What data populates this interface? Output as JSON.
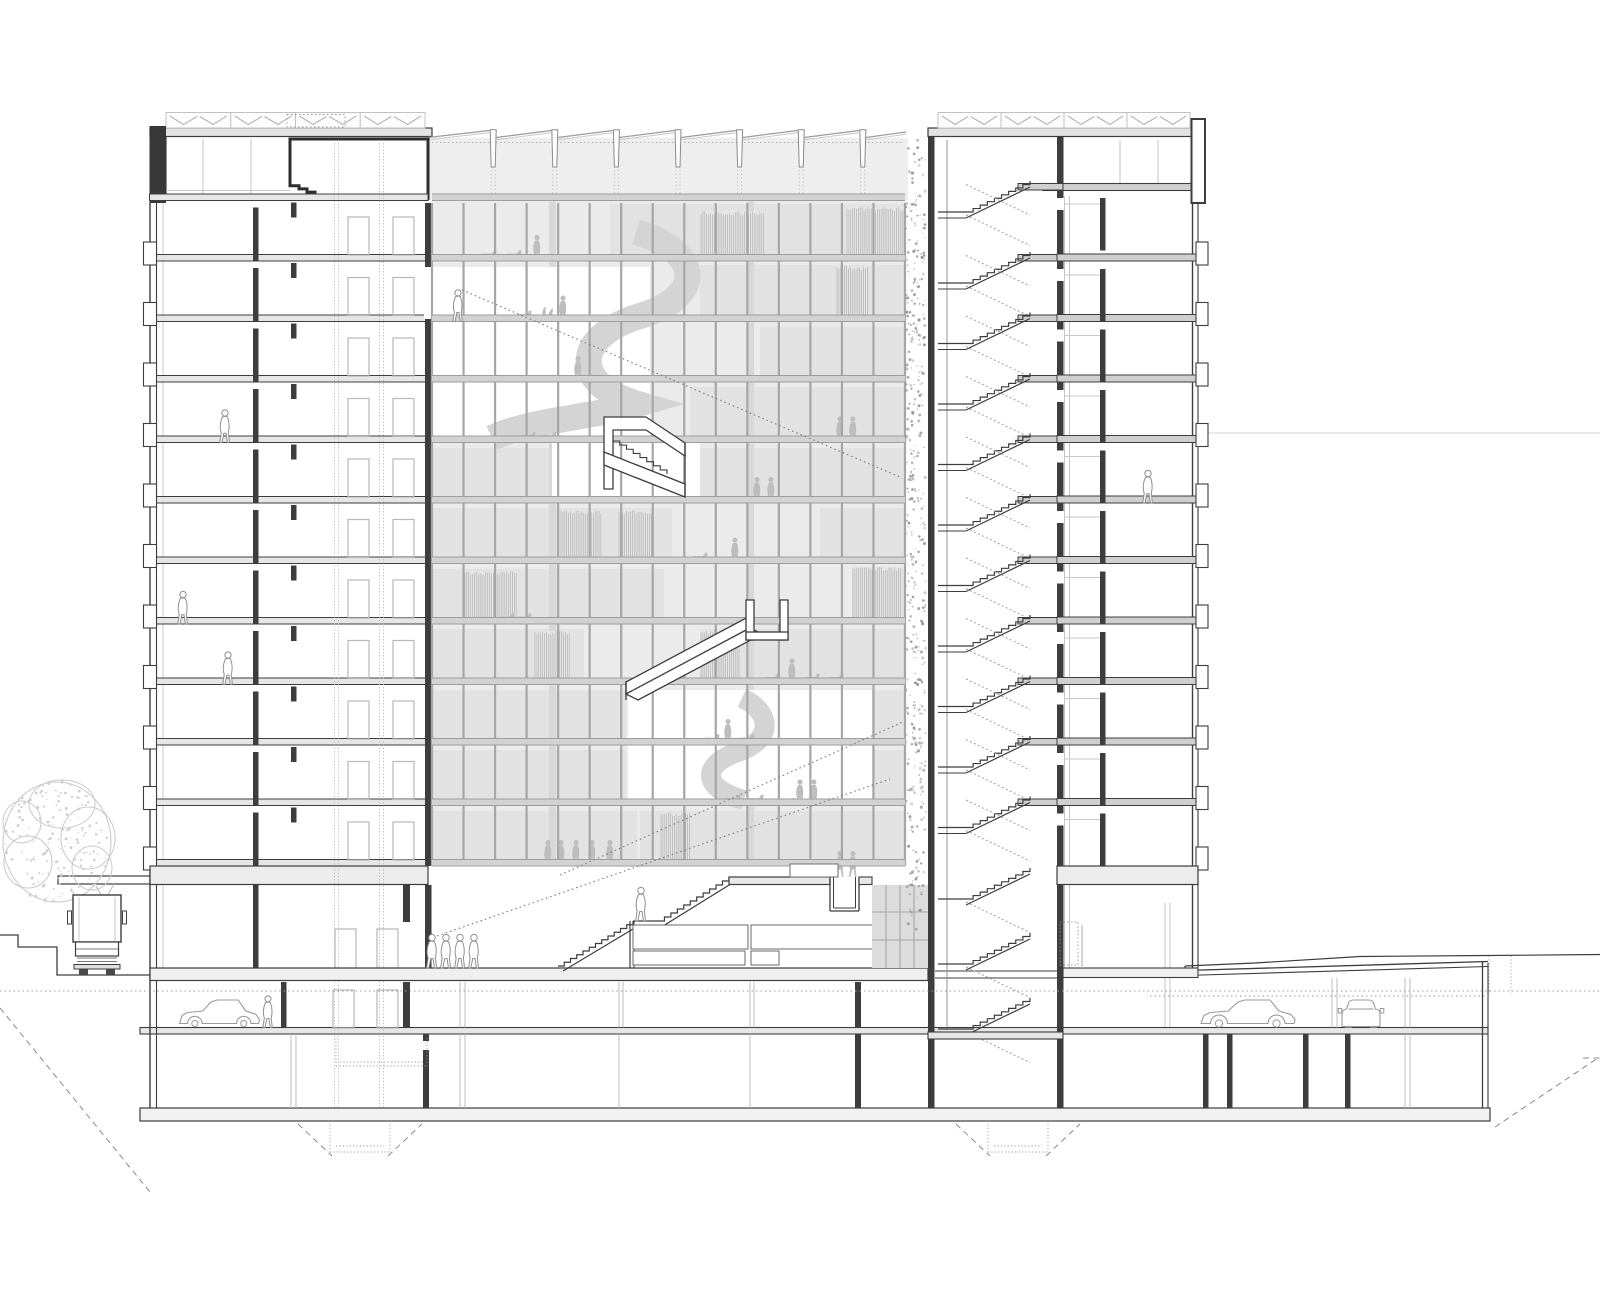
{
  "document": {
    "kind": "architectural cross-section drawing",
    "title": "Building section – atrium tower with underground parking",
    "style": "black and white technical line drawing, no text labels",
    "visible_text": []
  },
  "palette": {
    "paper": "#ffffff",
    "ink": "#3d3d3d",
    "inkMed": "#7a7a7a",
    "inkLight": "#b5b5b5",
    "inkXlight": "#d2d2d2",
    "atriumBg": "#ebebeb",
    "band": "#d2d2d2",
    "tint": "#e2e2e2",
    "strip": "#d8d8d8",
    "sil": "#bdbdbd",
    "silOut": "#8f8f8f",
    "hatch": "#b2b2b2",
    "sawFill": "#eeeeee",
    "glazing": "#dcdcdc",
    "green": "#8c8c8c",
    "spiral": "#d4d4d4",
    "slabFill": "#e6e6e6",
    "wheel": "#4a4a4a",
    "carLine": "#9a9a9a",
    "treeLine": "#c9c9c9"
  },
  "structure": {
    "storeys_above_ground": 13,
    "typical_floor_count": 11,
    "basement_levels": 2,
    "zones": [
      "left-wing",
      "central-atrium",
      "scissor-stair-core",
      "green-wall",
      "right-wing",
      "underground-parking"
    ],
    "roof": {
      "left_louver_panels": 4,
      "right_louver_panels": 4,
      "sawtooth_modules": 7
    },
    "core_flights_above_ground": 11,
    "core_flights_below_ground": 3,
    "atrium_mullion_bays": 15
  },
  "entities": {
    "people_outlined": 11,
    "people_filled": 19,
    "chairs": 16,
    "plants": 1,
    "dogs": 1,
    "cars": 3,
    "trucks": 1,
    "trees": 1,
    "spiral_stairs": 2,
    "straight_atrium_stairs": 1,
    "diagonal_bridges": 1,
    "grand_entry_stairs": 1
  },
  "annotations": {
    "sight_lines": 3,
    "groundwater_datum_line": true,
    "excavation_dashed_lines": true,
    "foundation_pits": 2
  }
}
